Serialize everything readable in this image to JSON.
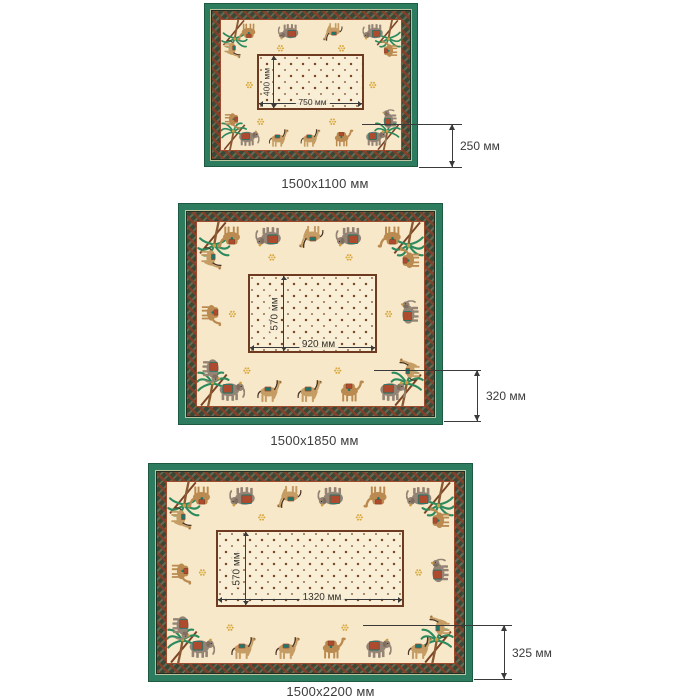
{
  "page": {
    "background": "#ffffff"
  },
  "figures": [
    {
      "id": "small",
      "caption": "1500x1100 мм",
      "center_width": "750 мм",
      "center_height": "400 мм",
      "border_height": "250 мм"
    },
    {
      "id": "medium",
      "caption": "1500x1850 мм",
      "center_width": "920 мм",
      "center_height": "570 мм",
      "border_height": "320 мм"
    },
    {
      "id": "large",
      "caption": "1500x2200 мм",
      "center_width": "1320 мм",
      "center_height": "570 мм",
      "border_height": "325 мм"
    }
  ],
  "colors": {
    "green": "#2d7c5f",
    "band": "#3b4836",
    "cream": "#f6e8c8",
    "panel": "#f9eed6",
    "accent_red": "#ae4a2d",
    "accent_teal": "#20756a",
    "gold": "#d8a83e",
    "dimension_line": "#3a3a3a",
    "text": "#3d3d3d"
  },
  "motifs": [
    "elephant-icon",
    "camel-icon",
    "horse-icon",
    "palm-tree-icon",
    "flower-dot-icon"
  ]
}
